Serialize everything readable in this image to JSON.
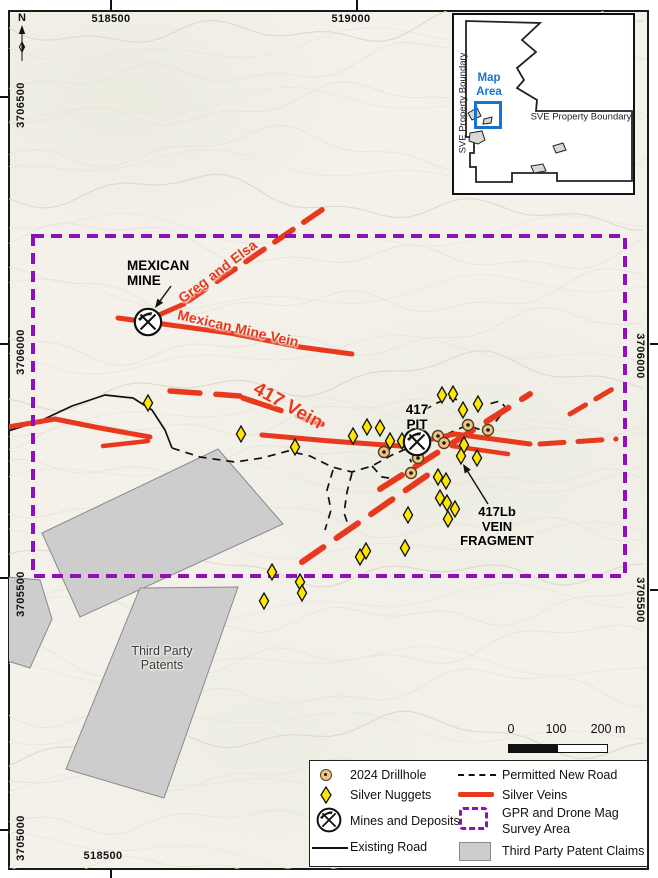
{
  "north": {
    "label": "N"
  },
  "map": {
    "coordinates": {
      "top": [
        {
          "label": "518500",
          "x": 111
        },
        {
          "label": "519000",
          "x": 357
        }
      ],
      "bottom": [
        {
          "label": "518500",
          "x": 111
        }
      ],
      "left": [
        {
          "label": "3706500",
          "y": 97
        },
        {
          "label": "3706000",
          "y": 344
        },
        {
          "label": "3705500",
          "y": 578
        },
        {
          "label": "3705000",
          "y": 830
        }
      ],
      "right": [
        {
          "label": "3706000",
          "y": 344
        },
        {
          "label": "3705500",
          "y": 590
        }
      ]
    }
  },
  "colors": {
    "vein_red": "#e8391f",
    "survey_purple": "#8e10b8",
    "nugget_yellow": "#ffe600",
    "drillhole_tan": "#f2c483",
    "patent_gray": "#cdcdcd",
    "map_area_blue": "#1873d0"
  },
  "map_labels": [
    {
      "name": "mexican-mine-label",
      "lines": [
        "MEXICAN",
        "MINE"
      ],
      "x": 127,
      "y": 258,
      "rot": 0,
      "color": "#000000",
      "size": 13.5,
      "bold": true,
      "align": "left",
      "anchor": "top"
    },
    {
      "name": "greg-and-elsa-label",
      "lines": [
        "Greg and Elsa"
      ],
      "x": 218,
      "y": 272,
      "rot": -37,
      "color": "#e8391f",
      "size": 14,
      "bold": true,
      "align": "center",
      "anchor": "mid"
    },
    {
      "name": "mexican-mine-vein-label",
      "lines": [
        "Mexican Mine Vein"
      ],
      "x": 238,
      "y": 329,
      "rot": 13,
      "color": "#e8391f",
      "size": 14,
      "bold": true,
      "align": "center",
      "anchor": "mid"
    },
    {
      "name": "vein-417-label",
      "lines": [
        "417 Vein"
      ],
      "x": 288,
      "y": 406,
      "rot": 29,
      "color": "#e8391f",
      "size": 19,
      "bold": true,
      "align": "center",
      "anchor": "mid"
    },
    {
      "name": "pit-417-label",
      "lines": [
        "417",
        "PIT"
      ],
      "x": 417,
      "y": 402,
      "rot": 0,
      "color": "#000000",
      "size": 13.5,
      "bold": true,
      "align": "center",
      "anchor": "top"
    },
    {
      "name": "vein-fragment-417lb-label",
      "lines": [
        "417Lb",
        "VEIN",
        "FRAGMENT"
      ],
      "x": 497,
      "y": 505,
      "rot": 0,
      "color": "#000000",
      "size": 13,
      "bold": true,
      "align": "center",
      "anchor": "top"
    },
    {
      "name": "third-party-patents-label",
      "lines": [
        "Third Party",
        "Patents"
      ],
      "x": 162,
      "y": 644,
      "rot": 0,
      "color": "#3a3a3a",
      "size": 12.5,
      "bold": false,
      "align": "center",
      "anchor": "top"
    }
  ],
  "features": {
    "survey_area": {
      "x": 33,
      "y": 236,
      "w": 592,
      "h": 340
    },
    "veins": [
      {
        "pts": [
          [
            118,
            318
          ],
          [
            148,
            322
          ],
          [
            230,
            333
          ],
          [
            300,
            347
          ],
          [
            352,
            354
          ]
        ],
        "w": 5,
        "dash": null
      },
      {
        "pts": [
          [
            152,
            318
          ],
          [
            184,
            304
          ]
        ],
        "w": 5,
        "dash": null
      },
      {
        "pts": [
          [
            8,
            427
          ],
          [
            55,
            419
          ],
          [
            100,
            428
          ],
          [
            150,
            437
          ]
        ],
        "w": 5,
        "dash": null
      },
      {
        "pts": [
          [
            103,
            446
          ],
          [
            148,
            441
          ]
        ],
        "w": 4.5,
        "dash": null
      },
      {
        "pts": [
          [
            262,
            435
          ],
          [
            330,
            441
          ],
          [
            400,
            446
          ],
          [
            455,
            434
          ],
          [
            530,
            444
          ]
        ],
        "w": 5,
        "dash": null
      },
      {
        "pts": [
          [
            452,
            446
          ],
          [
            508,
            454
          ]
        ],
        "w": 4.5,
        "dash": null
      },
      {
        "pts": [
          [
            188,
            301
          ],
          [
            332,
            203
          ]
        ],
        "w": 5.5,
        "dash": "22 13"
      },
      {
        "pts": [
          [
            170,
            391
          ],
          [
            240,
            396
          ]
        ],
        "w": 5.5,
        "dash": "30 16"
      },
      {
        "pts": [
          [
            243,
            398
          ],
          [
            322,
            424
          ]
        ],
        "w": 5.5,
        "dash": "40 18"
      },
      {
        "pts": [
          [
            540,
            444
          ],
          [
            616,
            439
          ]
        ],
        "w": 5,
        "dash": "24 14"
      },
      {
        "pts": [
          [
            380,
            489
          ],
          [
            530,
            394
          ]
        ],
        "w": 6,
        "dash": "26 16"
      },
      {
        "pts": [
          [
            302,
            562
          ],
          [
            432,
            472
          ]
        ],
        "w": 6,
        "dash": "26 16"
      },
      {
        "pts": [
          [
            570,
            414
          ],
          [
            616,
            387
          ]
        ],
        "w": 5,
        "dash": "18 12"
      }
    ],
    "existing_road": [
      [
        8,
        431
      ],
      [
        40,
        421
      ],
      [
        72,
        406
      ],
      [
        105,
        395
      ],
      [
        133,
        398
      ],
      [
        152,
        410
      ],
      [
        165,
        430
      ],
      [
        172,
        448
      ]
    ],
    "permitted_roads": [
      [
        [
          172,
          448
        ],
        [
          200,
          457
        ],
        [
          235,
          462
        ],
        [
          262,
          458
        ],
        [
          288,
          451
        ],
        [
          310,
          456
        ],
        [
          332,
          467
        ],
        [
          352,
          472
        ],
        [
          372,
          466
        ],
        [
          392,
          455
        ],
        [
          406,
          449
        ],
        [
          414,
          446
        ]
      ],
      [
        [
          420,
          444
        ],
        [
          432,
          439
        ],
        [
          443,
          436
        ],
        [
          456,
          430
        ],
        [
          468,
          425
        ],
        [
          478,
          429
        ],
        [
          488,
          430
        ],
        [
          497,
          420
        ],
        [
          506,
          408
        ],
        [
          500,
          401
        ],
        [
          489,
          404
        ]
      ],
      [
        [
          352,
          473
        ],
        [
          347,
          492
        ],
        [
          344,
          513
        ],
        [
          350,
          530
        ]
      ],
      [
        [
          333,
          470
        ],
        [
          327,
          490
        ],
        [
          331,
          510
        ],
        [
          325,
          530
        ]
      ],
      [
        [
          372,
          466
        ],
        [
          382,
          477
        ],
        [
          396,
          479
        ],
        [
          408,
          475
        ],
        [
          413,
          466
        ],
        [
          410,
          459
        ]
      ],
      [
        [
          424,
          410
        ],
        [
          437,
          403
        ],
        [
          449,
          398
        ],
        [
          459,
          400
        ]
      ]
    ],
    "mines": [
      {
        "x": 148,
        "y": 322
      },
      {
        "x": 417,
        "y": 442
      }
    ],
    "drillholes": [
      [
        384,
        452
      ],
      [
        418,
        458
      ],
      [
        411,
        473
      ],
      [
        438,
        436
      ],
      [
        444,
        443
      ],
      [
        468,
        425
      ],
      [
        488,
        430
      ]
    ],
    "nuggets": [
      [
        148,
        403
      ],
      [
        241,
        434
      ],
      [
        295,
        447
      ],
      [
        353,
        436
      ],
      [
        367,
        427
      ],
      [
        380,
        428
      ],
      [
        390,
        441
      ],
      [
        402,
        441
      ],
      [
        442,
        395
      ],
      [
        453,
        394
      ],
      [
        463,
        410
      ],
      [
        478,
        404
      ],
      [
        464,
        445
      ],
      [
        461,
        456
      ],
      [
        477,
        458
      ],
      [
        438,
        477
      ],
      [
        446,
        481
      ],
      [
        440,
        498
      ],
      [
        447,
        503
      ],
      [
        455,
        509
      ],
      [
        448,
        519
      ],
      [
        408,
        515
      ],
      [
        405,
        548
      ],
      [
        360,
        557
      ],
      [
        366,
        551
      ],
      [
        272,
        572
      ],
      [
        300,
        582
      ],
      [
        302,
        593
      ],
      [
        264,
        601
      ]
    ],
    "patents": [
      [
        [
          42,
          533
        ],
        [
          218,
          449
        ],
        [
          283,
          524
        ],
        [
          80,
          617
        ]
      ],
      [
        [
          140,
          588
        ],
        [
          238,
          587
        ],
        [
          164,
          798
        ],
        [
          66,
          769
        ]
      ],
      [
        [
          8,
          577
        ],
        [
          40,
          580
        ],
        [
          52,
          619
        ],
        [
          30,
          668
        ],
        [
          8,
          661
        ]
      ]
    ],
    "arrows": [
      {
        "from": [
          171,
          286
        ],
        "to": [
          155,
          308
        ]
      },
      {
        "from": [
          488,
          504
        ],
        "to": [
          463,
          464
        ]
      }
    ]
  },
  "inset": {
    "vertical_label": "SVE Property Boundary",
    "horizontal_label": "SVE Property Boundary",
    "map_area_label": "Map Area",
    "boundary_pts": [
      [
        466,
        21
      ],
      [
        540,
        23
      ],
      [
        522,
        40
      ],
      [
        536,
        52
      ],
      [
        517,
        68
      ],
      [
        524,
        80
      ],
      [
        517,
        88
      ],
      [
        537,
        100
      ],
      [
        536,
        111
      ],
      [
        632,
        111
      ],
      [
        632,
        181
      ],
      [
        557,
        181
      ],
      [
        557,
        173
      ],
      [
        512,
        173
      ],
      [
        512,
        182
      ],
      [
        476,
        182
      ],
      [
        476,
        167
      ],
      [
        470,
        167
      ],
      [
        470,
        153
      ],
      [
        474,
        153
      ],
      [
        474,
        137
      ],
      [
        466,
        137
      ]
    ],
    "claims": [
      [
        [
          468,
          113
        ],
        [
          477,
          108
        ],
        [
          481,
          116
        ],
        [
          472,
          120
        ]
      ],
      [
        [
          484,
          119
        ],
        [
          492,
          117
        ],
        [
          491,
          123
        ],
        [
          483,
          124
        ]
      ],
      [
        [
          470,
          133
        ],
        [
          482,
          131
        ],
        [
          485,
          140
        ],
        [
          478,
          144
        ],
        [
          469,
          141
        ]
      ],
      [
        [
          553,
          146
        ],
        [
          563,
          143
        ],
        [
          566,
          150
        ],
        [
          556,
          153
        ]
      ],
      [
        [
          531,
          166
        ],
        [
          543,
          164
        ],
        [
          546,
          171
        ],
        [
          534,
          173
        ]
      ]
    ]
  },
  "legend": {
    "col1": [
      {
        "symbol": "drillhole",
        "label": "2024 Drillhole"
      },
      {
        "symbol": "nugget",
        "label": "Silver Nuggets"
      },
      {
        "symbol": "mine",
        "label": "Mines and Deposits"
      },
      {
        "symbol": "existing-road",
        "label": "Existing Road"
      }
    ],
    "col2": [
      {
        "symbol": "new-road",
        "label": "Permitted New Road"
      },
      {
        "symbol": "vein",
        "label": "Silver Veins"
      },
      {
        "symbol": "survey-area",
        "label": "GPR and Drone Mag Survey Area"
      },
      {
        "symbol": "patent",
        "label": "Third Party Patent Claims"
      }
    ]
  },
  "scalebar": {
    "labels": [
      "0",
      "100",
      "200 m"
    ]
  }
}
